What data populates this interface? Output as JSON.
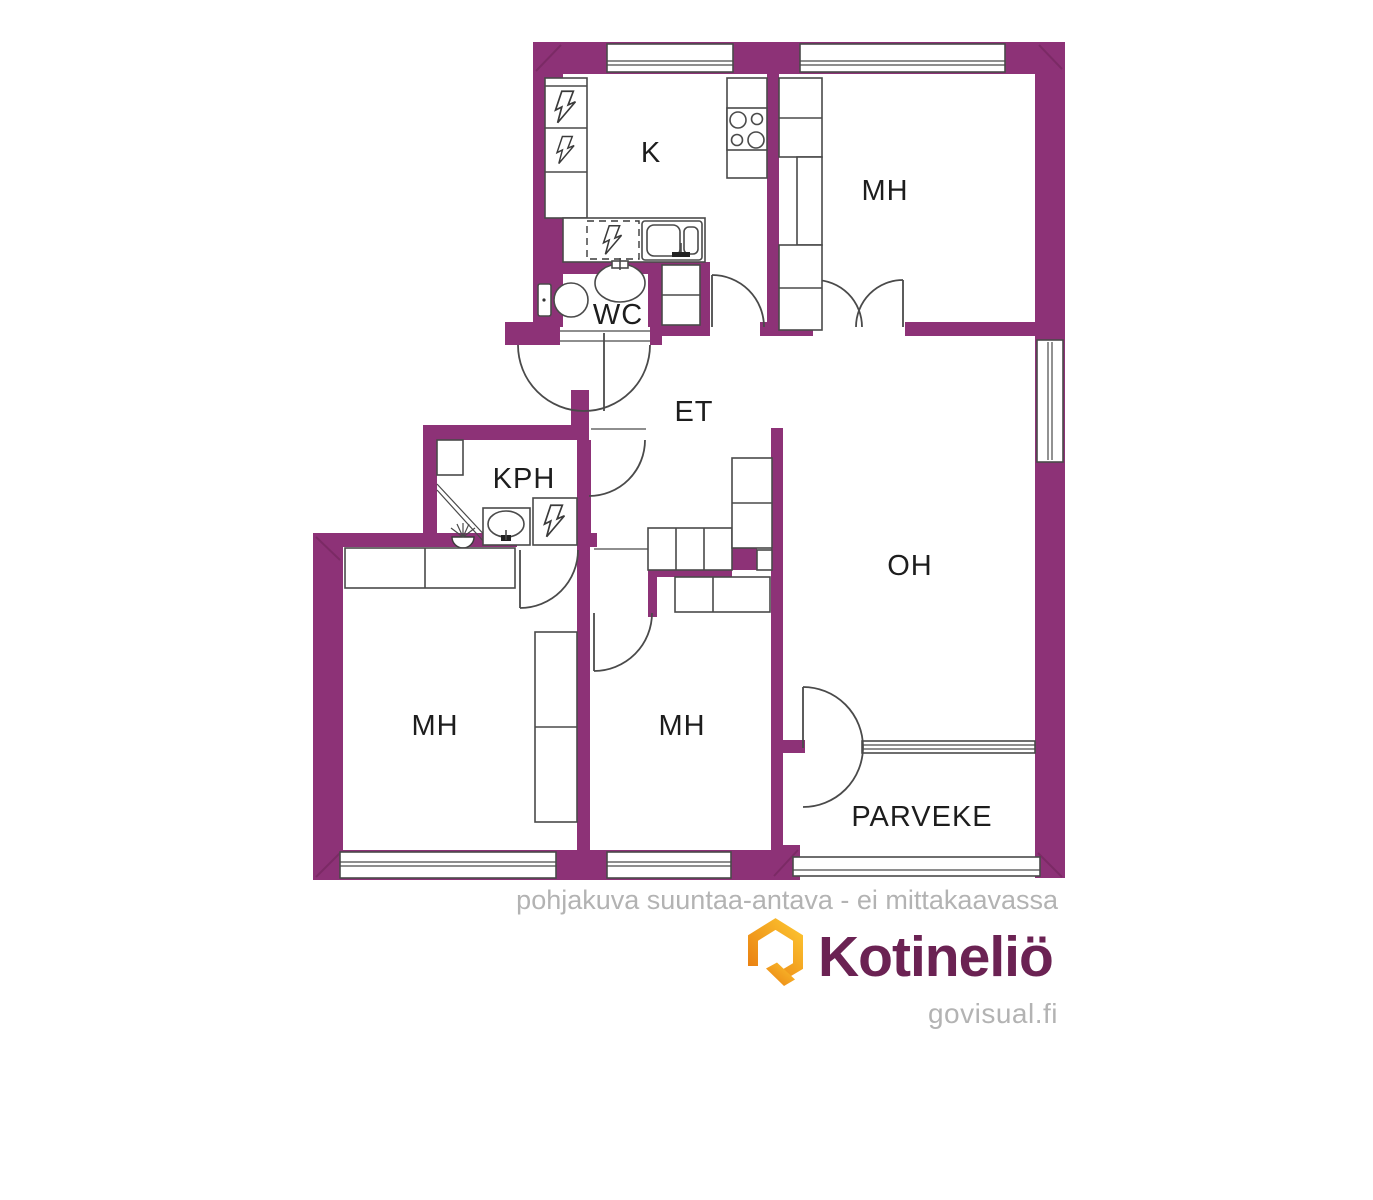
{
  "plan": {
    "type": "apartment-floor-plan",
    "rooms": [
      {
        "id": "kitchen",
        "label": "K"
      },
      {
        "id": "bedroom-top",
        "label": "MH"
      },
      {
        "id": "wc",
        "label": "WC"
      },
      {
        "id": "hallway",
        "label": "ET"
      },
      {
        "id": "bathroom",
        "label": "KPH"
      },
      {
        "id": "living-room",
        "label": "OH"
      },
      {
        "id": "bedroom-left",
        "label": "MH"
      },
      {
        "id": "bedroom-middle",
        "label": "MH"
      },
      {
        "id": "balcony",
        "label": "PARVEKE"
      }
    ],
    "icons": [
      "lightning-bolt-icon",
      "stove-burners-icon",
      "kitchen-sink-icon",
      "toilet-icon",
      "washbasin-icon",
      "shower-icon",
      "house-logo-icon"
    ],
    "colors": {
      "wall": "#8d3277",
      "fixture_line": "#4a4a4a",
      "label_text": "#1d1d1d",
      "muted_text": "#b3b3b3",
      "logo_purple": "#6b2253",
      "logo_orange_dark": "#e97f11",
      "logo_orange_light": "#fcc32f"
    }
  },
  "footer": {
    "disclaimer": "pohjakuva suuntaa-antava - ei mittakaavassa",
    "brand": "Kotineliö",
    "website": "govisual.fi"
  }
}
